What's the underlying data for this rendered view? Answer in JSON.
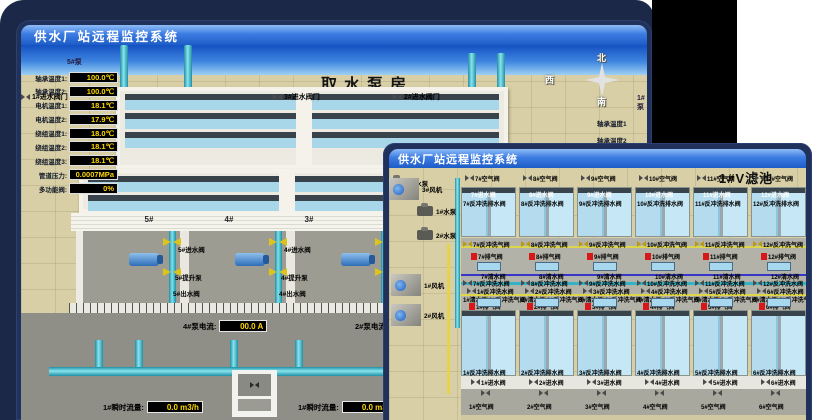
{
  "colors": {
    "titlebar_blue": "#2e6fd8",
    "backdrop_navy": "#1b2848",
    "value_yellow": "#ffd800",
    "alarm_red": "#d81818",
    "pipe_cyan": "#45c8dc",
    "valve_yellow": "#dcc41c",
    "water_blue": "#aadcee",
    "ground_tan": "#d8cfa6"
  },
  "back_window": {
    "title": "供水厂站远程监控系统",
    "scene_title": "取水泵房",
    "pump_panel": {
      "header": "5#泵",
      "rows": [
        {
          "label": "轴承温度1:",
          "value": "100.0℃"
        },
        {
          "label": "轴承温度2:",
          "value": "100.0℃"
        },
        {
          "label": "电机温度1:",
          "value": "18.1℃"
        },
        {
          "label": "电机温度2:",
          "value": "17.9℃"
        },
        {
          "label": "绕组温度1:",
          "value": "18.0℃"
        },
        {
          "label": "绕组温度2:",
          "value": "18.1℃"
        },
        {
          "label": "绕组温度3:",
          "value": "18.1℃"
        },
        {
          "label": "管道压力:",
          "value": "0.0007MPa"
        },
        {
          "label": "多功能阀:",
          "value": "0%"
        }
      ]
    },
    "inlet_gates": [
      "3#进水阀门",
      "2#进水阀门",
      "1#进水阀门"
    ],
    "compass": {
      "north": "北",
      "west": "西",
      "south": "南",
      "east": "东"
    },
    "right_panel": {
      "header": "1#泵",
      "labels": [
        "轴承温度1",
        "轴承温度2"
      ]
    },
    "bays": [
      {
        "no": "5#",
        "inlet": "5#进水阀",
        "pump": "5#提升泵",
        "outlet": "5#出水阀"
      },
      {
        "no": "4#",
        "inlet": "4#进水阀",
        "pump": "4#提升泵",
        "outlet": "4#出水阀"
      },
      {
        "no": "3#",
        "inlet": "3#进水阀",
        "pump": "3#提升泵",
        "outlet": "3#出水阀"
      },
      {
        "no": "2#",
        "inlet": "2#进水阀",
        "pump": "2#提升泵",
        "outlet": "2#出水阀"
      }
    ],
    "currents": [
      {
        "label": "4#泵电流:",
        "value": "00.0 A"
      },
      {
        "label": "2#泵电流:",
        "value": ""
      }
    ],
    "flows": [
      {
        "label": "1#瞬时流量:",
        "value": "0.0 m3/h"
      },
      {
        "label": "1#瞬时流量:",
        "value": "0.0 m3/h"
      }
    ]
  },
  "front_window": {
    "title": "供水厂站远程监控系统",
    "scene_title": "1#V滤池",
    "pumps": [
      "1#水泵",
      "2#水泵",
      "3#水泵"
    ],
    "blowers": [
      "1#风机",
      "2#风机",
      "3#风机"
    ],
    "columns": [
      {
        "top_air": "7#空气阀",
        "top_inlet": "7#进水阀",
        "top_drain": "7#反冲洗排水阀",
        "top_bw_air": "7#反冲洗气阀",
        "top_vent": "7#排气阀",
        "top_clean": "7#清水阀",
        "top_bw_water": "7#反冲洗水阀",
        "bot_bw_water": "1#反冲洗水阀",
        "bot_clean": "1#清水阀",
        "bot_bw_air": "1#反冲洗气阀",
        "bot_vent": "1#排气阀",
        "bot_drain": "1#反冲洗排水阀",
        "bot_inlet": "1#进水阀",
        "bot_air": "1#空气阀"
      },
      {
        "top_air": "8#空气阀",
        "top_inlet": "8#进水阀",
        "top_drain": "8#反冲洗排水阀",
        "top_bw_air": "8#反冲洗气阀",
        "top_vent": "8#排气阀",
        "top_clean": "8#清水阀",
        "top_bw_water": "8#反冲洗水阀",
        "bot_bw_water": "2#反冲洗水阀",
        "bot_clean": "2#清水阀",
        "bot_bw_air": "2#反冲洗气阀",
        "bot_vent": "2#排气阀",
        "bot_drain": "2#反冲洗排水阀",
        "bot_inlet": "2#进水阀",
        "bot_air": "2#空气阀"
      },
      {
        "top_air": "9#空气阀",
        "top_inlet": "9#进水阀",
        "top_drain": "9#反冲洗排水阀",
        "top_bw_air": "9#反冲洗气阀",
        "top_vent": "9#排气阀",
        "top_clean": "9#清水阀",
        "top_bw_water": "9#反冲洗水阀",
        "bot_bw_water": "3#反冲洗水阀",
        "bot_clean": "3#清水阀",
        "bot_bw_air": "3#反冲洗气阀",
        "bot_vent": "3#排气阀",
        "bot_drain": "3#反冲洗排水阀",
        "bot_inlet": "3#进水阀",
        "bot_air": "3#空气阀"
      },
      {
        "top_air": "10#空气阀",
        "top_inlet": "10#进水阀",
        "top_drain": "10#反冲洗排水阀",
        "top_bw_air": "10#反冲洗气阀",
        "top_vent": "10#排气阀",
        "top_clean": "10#清水阀",
        "top_bw_water": "10#反冲洗水阀",
        "bot_bw_water": "4#反冲洗水阀",
        "bot_clean": "4#清水阀",
        "bot_bw_air": "4#反冲洗气阀",
        "bot_vent": "4#排气阀",
        "bot_drain": "4#反冲洗排水阀",
        "bot_inlet": "4#进水阀",
        "bot_air": "4#空气阀"
      },
      {
        "top_air": "11#空气阀",
        "top_inlet": "11#进水阀",
        "top_drain": "11#反冲洗排水阀",
        "top_bw_air": "11#反冲洗气阀",
        "top_vent": "11#排气阀",
        "top_clean": "11#清水阀",
        "top_bw_water": "11#反冲洗水阀",
        "bot_bw_water": "5#反冲洗水阀",
        "bot_clean": "5#清水阀",
        "bot_bw_air": "5#反冲洗气阀",
        "bot_vent": "5#排气阀",
        "bot_drain": "5#反冲洗排水阀",
        "bot_inlet": "5#进水阀",
        "bot_air": "5#空气阀"
      },
      {
        "top_air": "12#空气阀",
        "top_inlet": "12#进水阀",
        "top_drain": "12#反冲洗排水阀",
        "top_bw_air": "12#反冲洗气阀",
        "top_vent": "12#排气阀",
        "top_clean": "12#清水阀",
        "top_bw_water": "12#反冲洗水阀",
        "bot_bw_water": "6#反冲洗水阀",
        "bot_clean": "6#清水阀",
        "bot_bw_air": "6#反冲洗气阀",
        "bot_vent": "6#排气阀",
        "bot_drain": "6#反冲洗排水阀",
        "bot_inlet": "6#进水阀",
        "bot_air": "6#空气阀"
      }
    ]
  }
}
